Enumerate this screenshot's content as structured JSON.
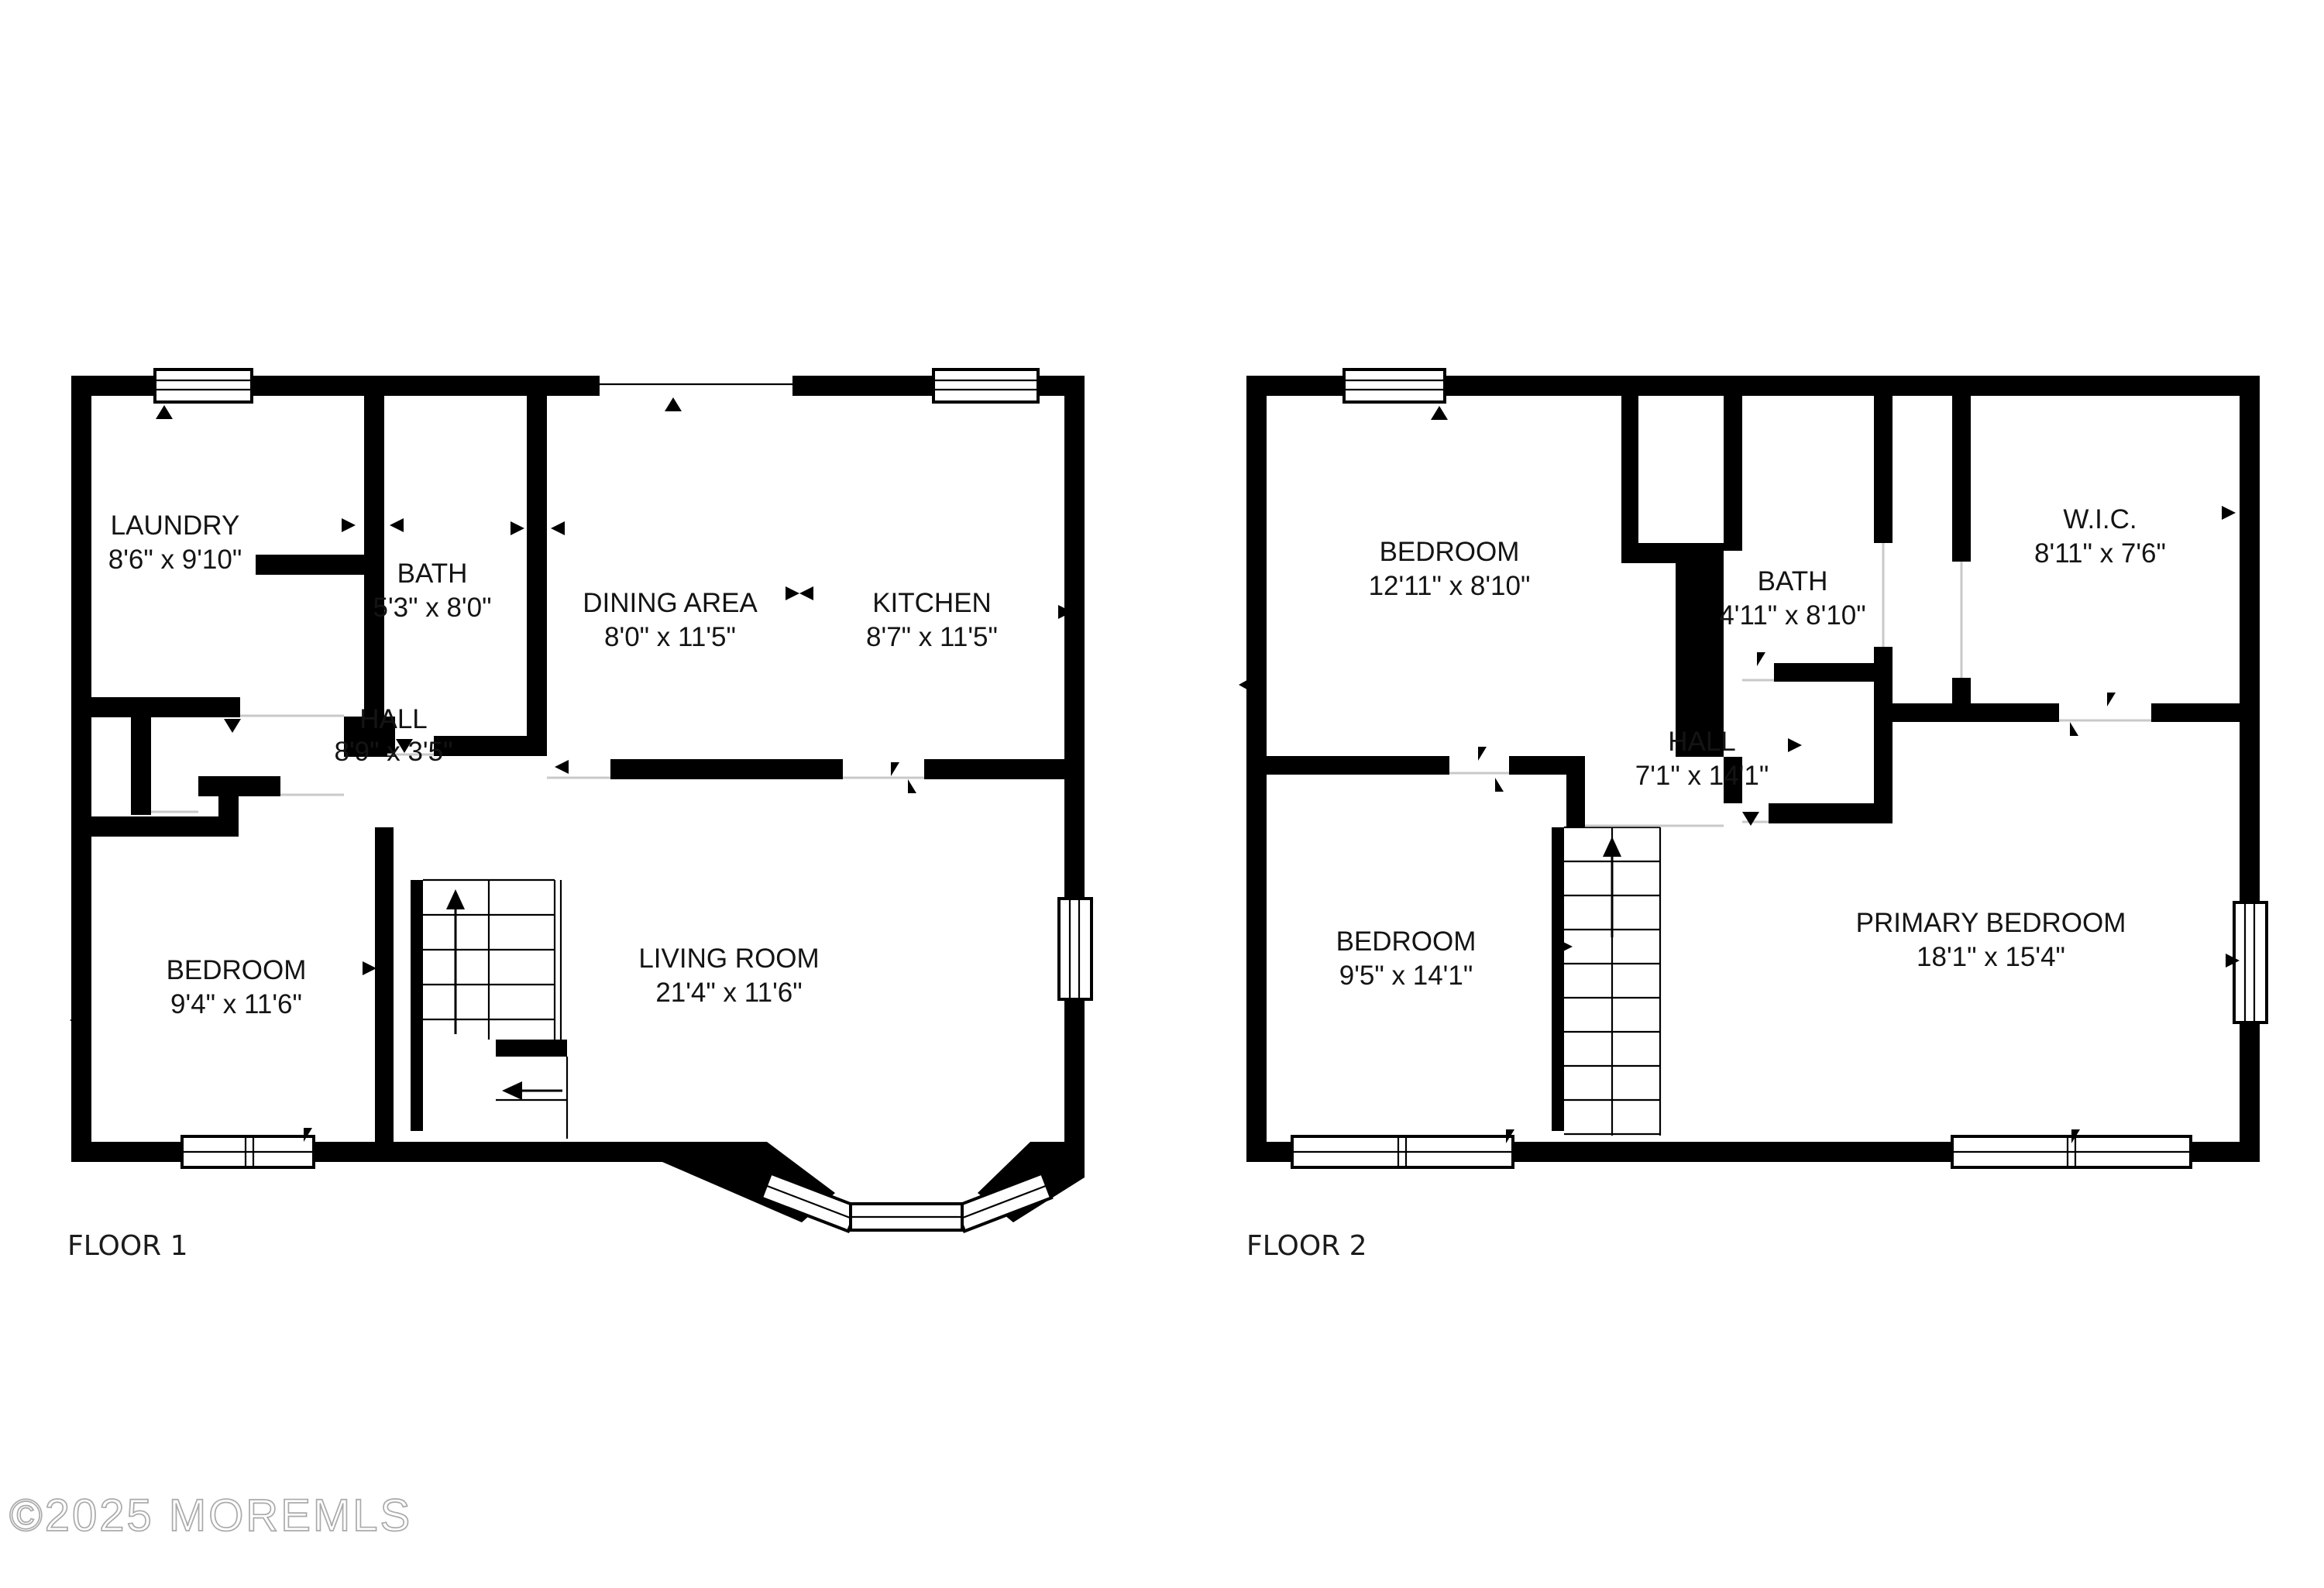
{
  "title": "Floor plan",
  "colors": {
    "wall": "#000000",
    "background": "#ffffff",
    "label": "#141414",
    "watermark": "#aaaaaa"
  },
  "floors": [
    {
      "label": "FLOOR 1",
      "rooms": [
        {
          "name": "LAUNDRY",
          "dims": "8'6\" x 9'10\""
        },
        {
          "name": "BATH",
          "dims": "5'3\" x 8'0\""
        },
        {
          "name": "DINING AREA",
          "dims": "8'0\" x 11'5\""
        },
        {
          "name": "KITCHEN",
          "dims": "8'7\" x 11'5\""
        },
        {
          "name": "HALL",
          "dims": "8'9\" x 3'5\""
        },
        {
          "name": "BEDROOM",
          "dims": "9'4\" x 11'6\""
        },
        {
          "name": "LIVING ROOM",
          "dims": "21'4\" x 11'6\""
        }
      ]
    },
    {
      "label": "FLOOR 2",
      "rooms": [
        {
          "name": "BEDROOM",
          "dims": "12'11\" x 8'10\""
        },
        {
          "name": "BATH",
          "dims": "4'11\" x 8'10\""
        },
        {
          "name": "W.I.C.",
          "dims": "8'11\" x 7'6\""
        },
        {
          "name": "HALL",
          "dims": "7'1\" x 14'1\""
        },
        {
          "name": "BEDROOM",
          "dims": "9'5\" x 14'1\""
        },
        {
          "name": "PRIMARY BEDROOM",
          "dims": "18'1\" x 15'4\""
        }
      ]
    }
  ],
  "watermark": "©2025 MOREMLS"
}
